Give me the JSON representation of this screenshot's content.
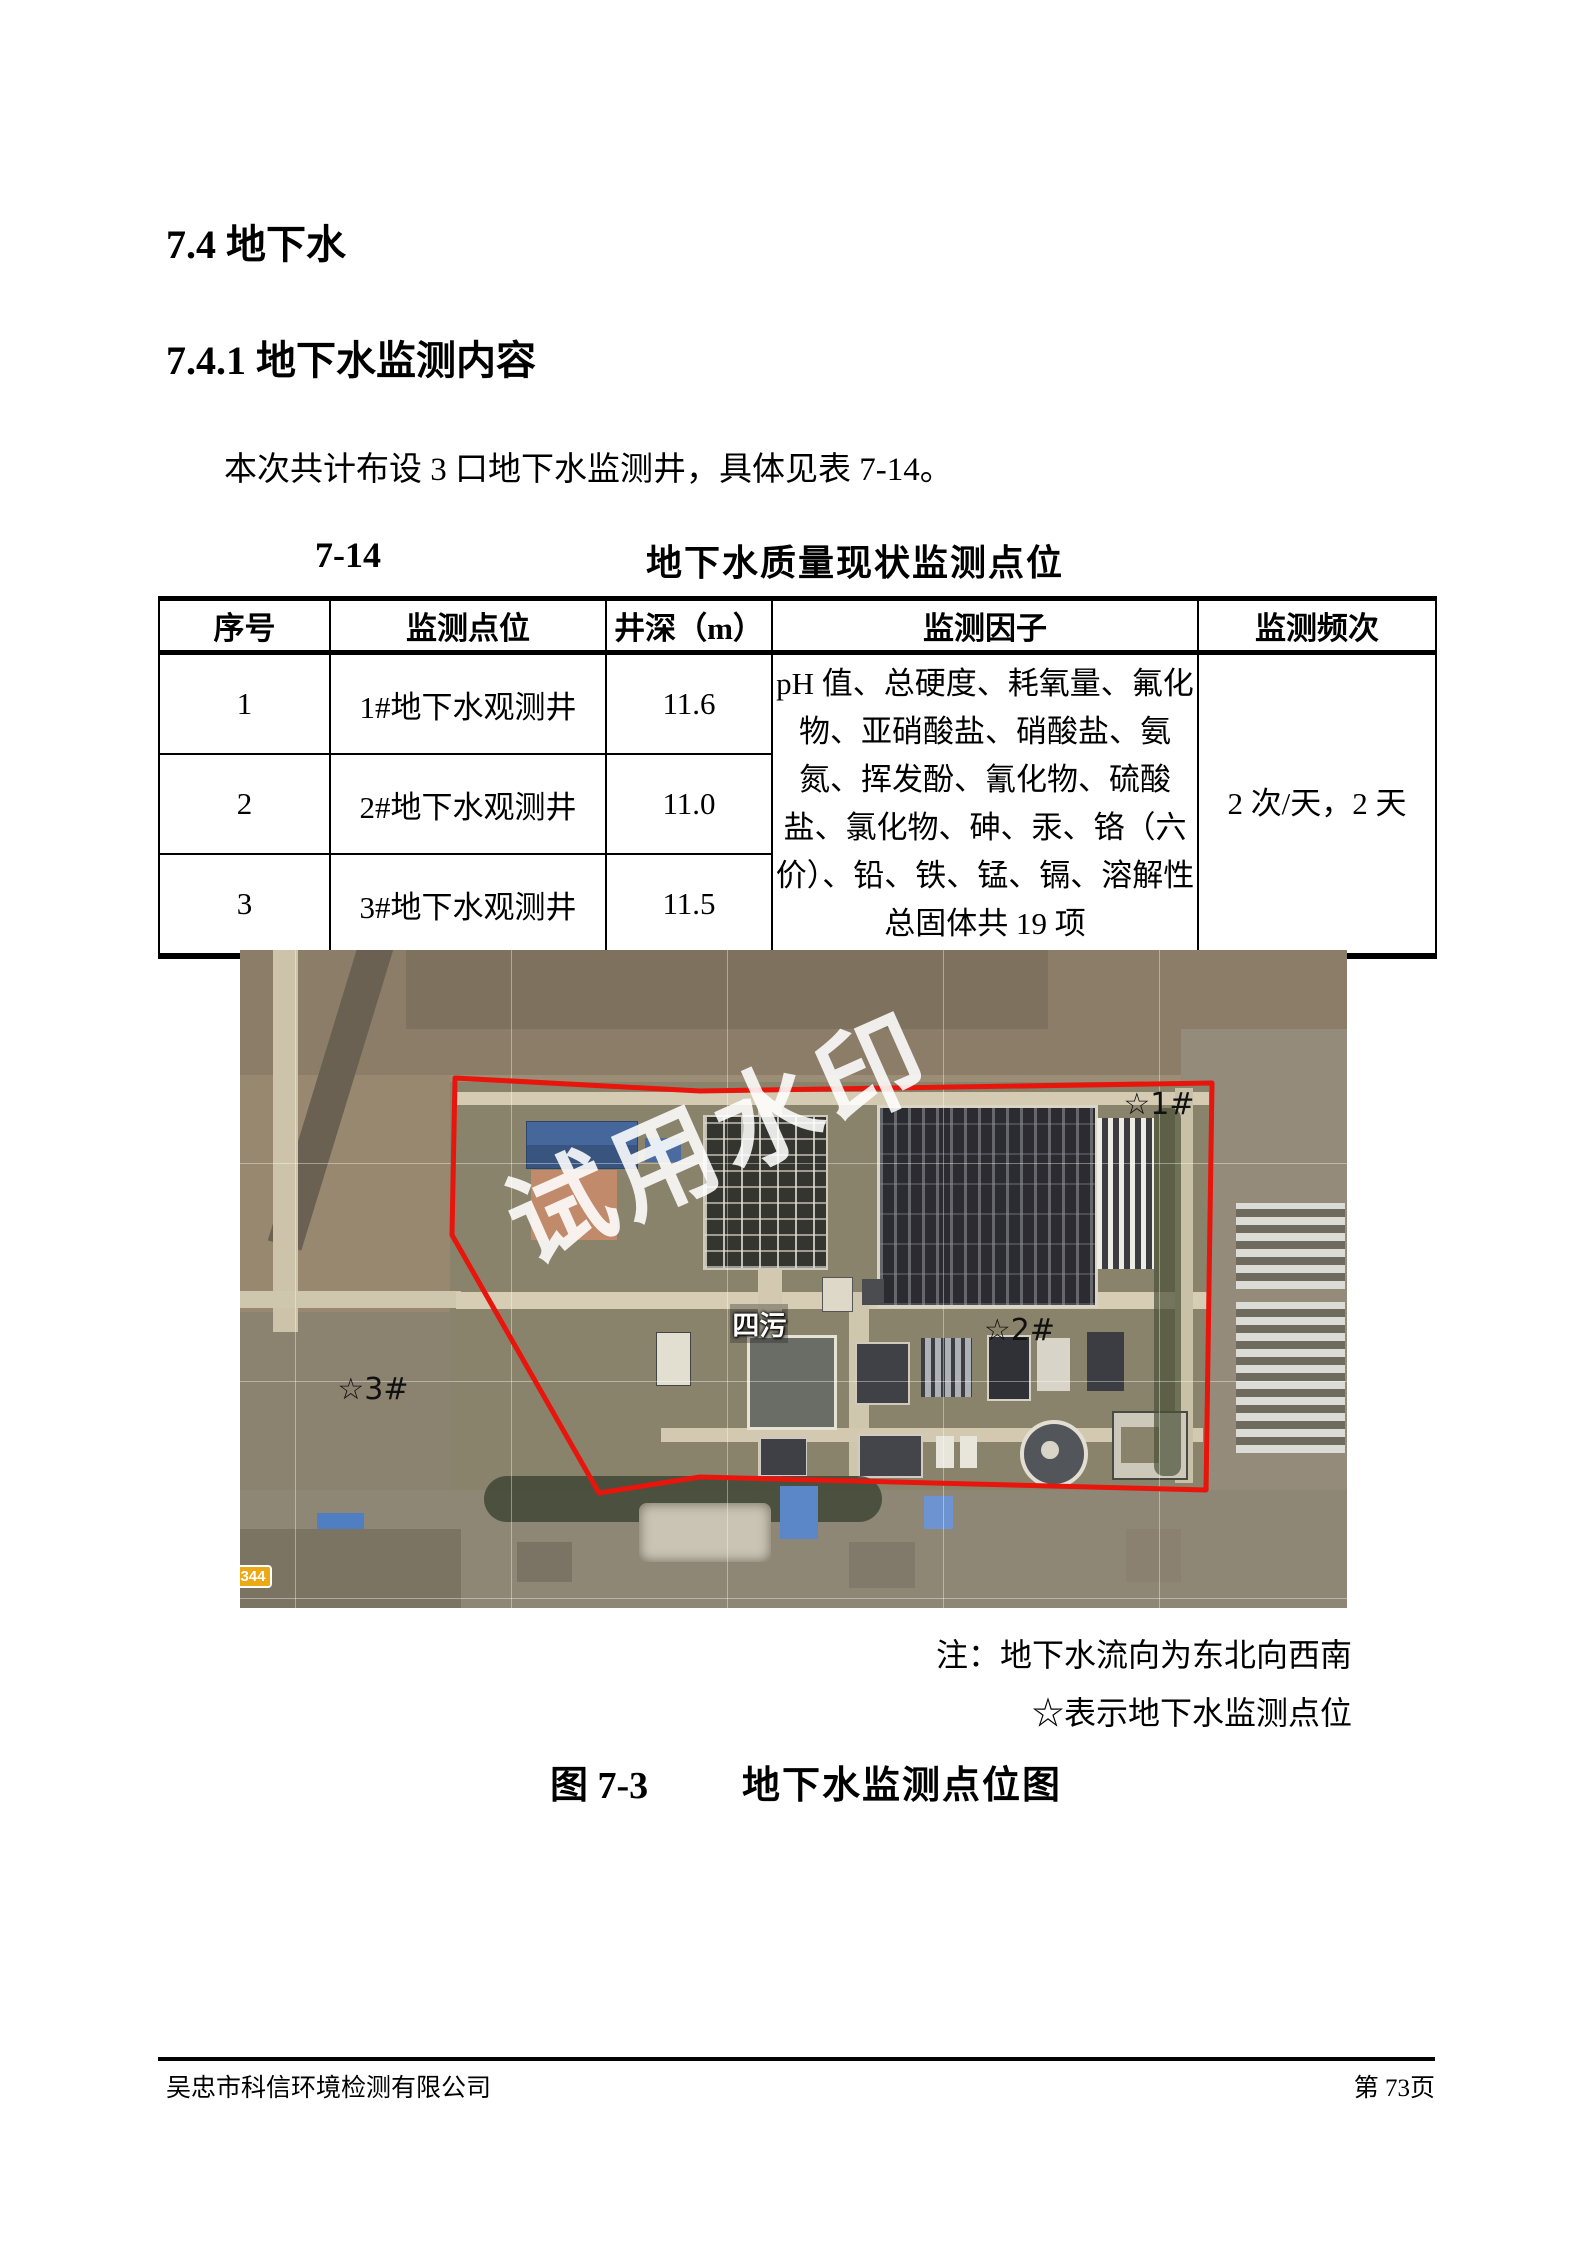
{
  "page": {
    "section_heading": "7.4 地下水",
    "subsection_heading": "7.4.1 地下水监测内容",
    "paragraph": "本次共计布设 3 口地下水监测井，具体见表 7-14。",
    "footer_company": "吴忠市科信环境检测有限公司",
    "footer_page": "第 73页"
  },
  "table": {
    "number": "7-14",
    "title": "地下水质量现状监测点位",
    "headers": [
      "序号",
      "监测点位",
      "井深（m）",
      "监测因子",
      "监测频次"
    ],
    "rows": [
      {
        "no": "1",
        "point": "1#地下水观测井",
        "depth": "11.6"
      },
      {
        "no": "2",
        "point": "2#地下水观测井",
        "depth": "11.0"
      },
      {
        "no": "3",
        "point": "3#地下水观测井",
        "depth": "11.5"
      }
    ],
    "factors": "pH 值、总硬度、耗氧量、氟化物、亚硝酸盐、硝酸盐、氨氮、挥发酚、氰化物、硫酸盐、氯化物、砷、汞、铬（六价）、铅、铁、锰、镉、溶解性总固体共 19 项",
    "frequency": "2 次/天，2 天"
  },
  "figure": {
    "watermark": "试用水印",
    "map": {
      "well1": "☆1#",
      "well2": "☆2#",
      "well3": "☆3#",
      "plant_label": "四污",
      "road_badge": "344"
    },
    "boundary_color": "#e8150c",
    "badge_color": "#eca815",
    "note1": "注：地下水流向为东北向西南",
    "note2": "☆表示地下水监测点位",
    "caption_number": "图 7-3",
    "caption_title": "地下水监测点位图"
  }
}
